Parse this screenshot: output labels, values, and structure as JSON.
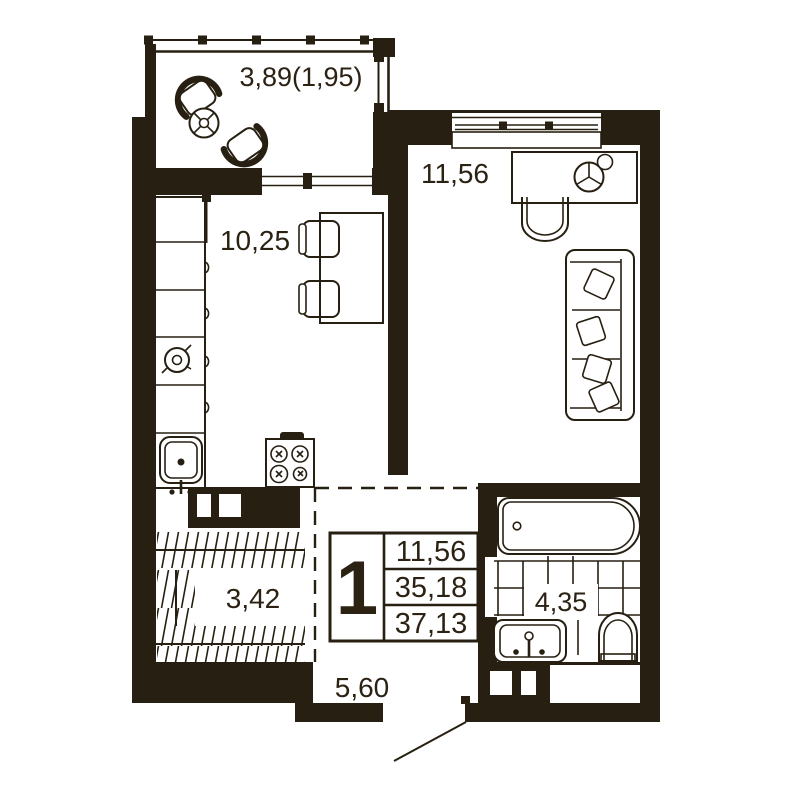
{
  "colors": {
    "wall": "#271f11",
    "line": "#271f11",
    "text": "#2b2213",
    "bg": "#ffffff"
  },
  "plan": {
    "type": "apartment-floor-plan",
    "rooms": [
      {
        "id": "balcony",
        "area_label": "3,89(1,95)",
        "furniture": [
          "armchair",
          "armchair",
          "round-table"
        ]
      },
      {
        "id": "living-room",
        "area_label": "11,56",
        "furniture": [
          "desk",
          "chair",
          "plant",
          "sofa"
        ]
      },
      {
        "id": "kitchen",
        "area_label": "10,25",
        "furniture": [
          "counter",
          "sink",
          "stove",
          "table",
          "chair",
          "chair"
        ]
      },
      {
        "id": "hallway",
        "area_label": "3,42",
        "furniture": [
          "wardrobe"
        ]
      },
      {
        "id": "bathroom",
        "area_label": "4,35",
        "furniture": [
          "bathtub",
          "wash-basin",
          "toilet"
        ]
      },
      {
        "id": "entry",
        "area_label": "5,60",
        "furniture": [
          "entry-door"
        ]
      }
    ]
  },
  "labels": {
    "balcony_area": "3,89(1,95)",
    "living_area": "11,56",
    "kitchen_area": "10,25",
    "hall_area": "3,42",
    "bath_area": "4,35",
    "entry_area": "5,60"
  },
  "stamp": {
    "rooms_count": "1",
    "living_area": "11,56",
    "apartment_area": "35,18",
    "total_area": "37,13"
  }
}
